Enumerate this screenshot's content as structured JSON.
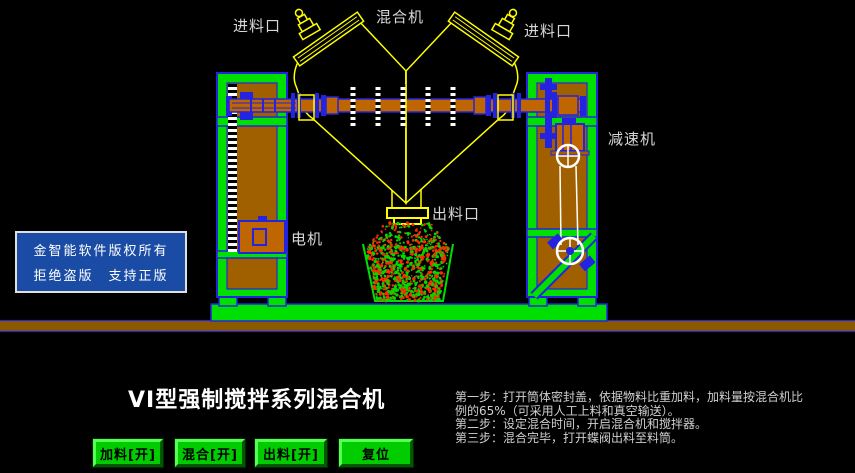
{
  "palette": {
    "background": "#000000",
    "machine_yellow": "#FFFF00",
    "structure_green": "#00E000",
    "outline_blue": "#2424E0",
    "panel_brown": "#A06000",
    "shaft_brown": "#C06600",
    "ground_brown": "#8B5A00",
    "belt_white": "#FFFFFF",
    "particle_red": "#FF2A00",
    "particle_green": "#00D800",
    "button_green": "#00CC00",
    "label_color": "#D8D8D8",
    "copyright_bg": "#1A4CA6"
  },
  "diagram_labels": {
    "feed_inlet_left": "进料口",
    "mixer_top": "混合机",
    "feed_inlet_right": "进料口",
    "reducer": "减速机",
    "motor": "电机",
    "discharge_outlet": "出料口"
  },
  "copyright": {
    "line1": "金智能软件版权所有",
    "line2": "拒绝盗版　支持正版"
  },
  "title": "VI型强制搅拌系列混合机",
  "instructions": {
    "lines": [
      "第一步：打开筒体密封盖，依据物料比重加料，加料量按混合机比",
      "例的65%（可采用人工上料和真空输送）。",
      "第二步：设定混合时间，开启混合机和搅拌器。",
      "第三步：混合完毕，打开蝶阀出料至料筒。"
    ]
  },
  "buttons": [
    {
      "label": "加料[开]"
    },
    {
      "label": "混合[开]"
    },
    {
      "label": "出料[开]"
    },
    {
      "label": "复位"
    }
  ]
}
